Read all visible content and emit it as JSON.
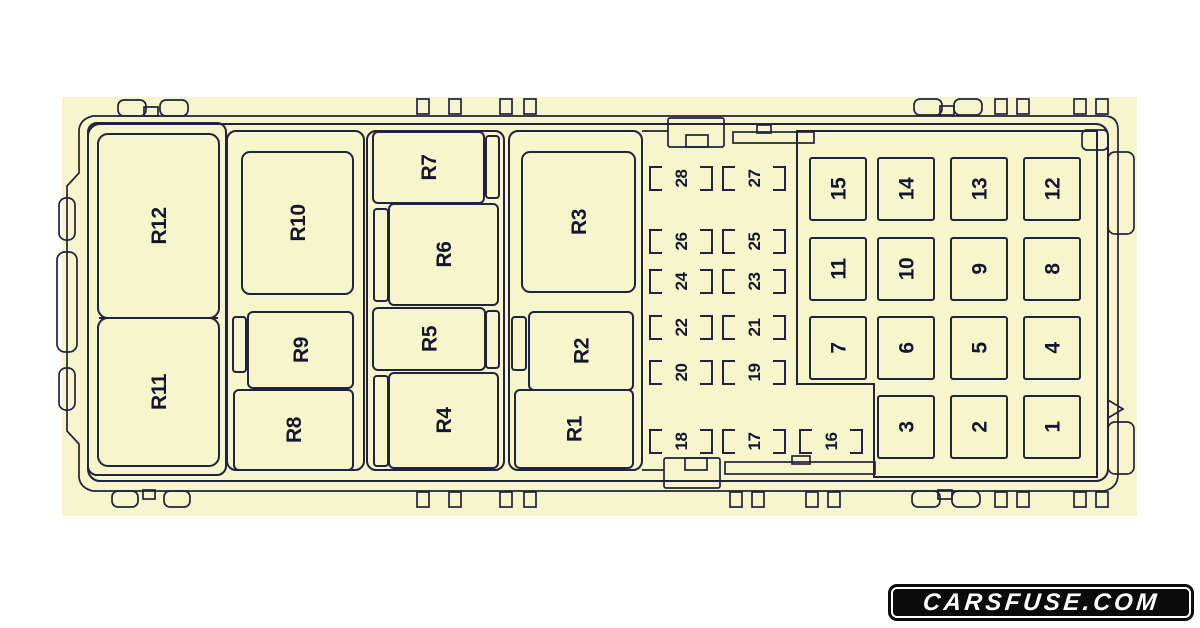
{
  "watermark": {
    "text": "CARSFUSE.COM"
  },
  "theme": {
    "page_bg": "#ffffff",
    "panel": "#f7f5cb",
    "line": "#22223e",
    "label": "#15152e",
    "logo_bg": "#0b0b0b",
    "logo_fg": "#ffffff"
  },
  "diagram": {
    "panel": {
      "x": 62,
      "y": 97,
      "w": 1075,
      "h": 419
    },
    "containers": [
      {
        "x": 88,
        "y": 123,
        "w": 138,
        "h": 352
      },
      {
        "x": 227,
        "y": 131,
        "w": 137,
        "h": 339
      },
      {
        "x": 367,
        "y": 131,
        "w": 137,
        "h": 339
      },
      {
        "x": 509,
        "y": 131,
        "w": 133,
        "h": 339
      }
    ],
    "divider": {
      "x1": 99,
      "y1": 318,
      "x2": 218,
      "y2": 318
    },
    "relays": [
      {
        "label": "R12",
        "x": 98,
        "y": 134,
        "w": 121,
        "h": 184,
        "rx": 10
      },
      {
        "label": "R11",
        "x": 98,
        "y": 318,
        "w": 121,
        "h": 148,
        "rx": 10
      },
      {
        "label": "R10",
        "x": 242,
        "y": 152,
        "w": 111,
        "h": 142,
        "rx": 8
      },
      {
        "label": "R9",
        "x": 248,
        "y": 312,
        "w": 105,
        "h": 76,
        "rx": 5,
        "tab": {
          "x": 233,
          "y": 317,
          "w": 13,
          "h": 55
        }
      },
      {
        "label": "R8",
        "x": 234,
        "y": 390,
        "w": 119,
        "h": 80,
        "rx": 5
      },
      {
        "label": "R7",
        "x": 373,
        "y": 132,
        "w": 111,
        "h": 71,
        "rx": 5,
        "tab": {
          "x": 486,
          "y": 136,
          "w": 13,
          "h": 62
        }
      },
      {
        "label": "R6",
        "x": 389,
        "y": 204,
        "w": 109,
        "h": 101,
        "rx": 5,
        "tab": {
          "x": 374,
          "y": 209,
          "w": 14,
          "h": 92
        }
      },
      {
        "label": "R5",
        "x": 373,
        "y": 308,
        "w": 112,
        "h": 62,
        "rx": 5,
        "tab": {
          "x": 486,
          "y": 311,
          "w": 13,
          "h": 57
        }
      },
      {
        "label": "R4",
        "x": 389,
        "y": 373,
        "w": 109,
        "h": 95,
        "rx": 5,
        "tab": {
          "x": 374,
          "y": 376,
          "w": 14,
          "h": 90
        }
      },
      {
        "label": "R3",
        "x": 522,
        "y": 152,
        "w": 113,
        "h": 140,
        "rx": 8
      },
      {
        "label": "R2",
        "x": 529,
        "y": 312,
        "w": 104,
        "h": 78,
        "rx": 5,
        "tab": {
          "x": 512,
          "y": 317,
          "w": 14,
          "h": 53
        }
      },
      {
        "label": "R1",
        "x": 515,
        "y": 390,
        "w": 118,
        "h": 78,
        "rx": 5
      }
    ],
    "mini_fuse_size": {
      "w": 62,
      "h": 23
    },
    "mini_fuses": [
      {
        "label": "28",
        "x": 650,
        "y": 167
      },
      {
        "label": "27",
        "x": 723,
        "y": 167
      },
      {
        "label": "26",
        "x": 650,
        "y": 230
      },
      {
        "label": "25",
        "x": 723,
        "y": 230
      },
      {
        "label": "24",
        "x": 650,
        "y": 270
      },
      {
        "label": "23",
        "x": 723,
        "y": 270
      },
      {
        "label": "22",
        "x": 650,
        "y": 316
      },
      {
        "label": "21",
        "x": 723,
        "y": 316
      },
      {
        "label": "20",
        "x": 650,
        "y": 361
      },
      {
        "label": "19",
        "x": 723,
        "y": 361
      },
      {
        "label": "18",
        "x": 650,
        "y": 430
      },
      {
        "label": "17",
        "x": 723,
        "y": 430
      },
      {
        "label": "16",
        "x": 800,
        "y": 430
      }
    ],
    "grid_fuse_size": {
      "w": 56,
      "h": 62
    },
    "grid_fuses": [
      {
        "label": "15",
        "x": 810,
        "y": 158
      },
      {
        "label": "14",
        "x": 878,
        "y": 158
      },
      {
        "label": "13",
        "x": 951,
        "y": 158
      },
      {
        "label": "12",
        "x": 1024,
        "y": 158
      },
      {
        "label": "11",
        "x": 810,
        "y": 238
      },
      {
        "label": "10",
        "x": 878,
        "y": 238
      },
      {
        "label": "9",
        "x": 951,
        "y": 238
      },
      {
        "label": "8",
        "x": 1024,
        "y": 238
      },
      {
        "label": "7",
        "x": 810,
        "y": 317
      },
      {
        "label": "6",
        "x": 878,
        "y": 317
      },
      {
        "label": "5",
        "x": 951,
        "y": 317
      },
      {
        "label": "4",
        "x": 1024,
        "y": 317
      },
      {
        "label": "3",
        "x": 878,
        "y": 396
      },
      {
        "label": "2",
        "x": 951,
        "y": 396
      },
      {
        "label": "1",
        "x": 1024,
        "y": 396
      }
    ]
  }
}
